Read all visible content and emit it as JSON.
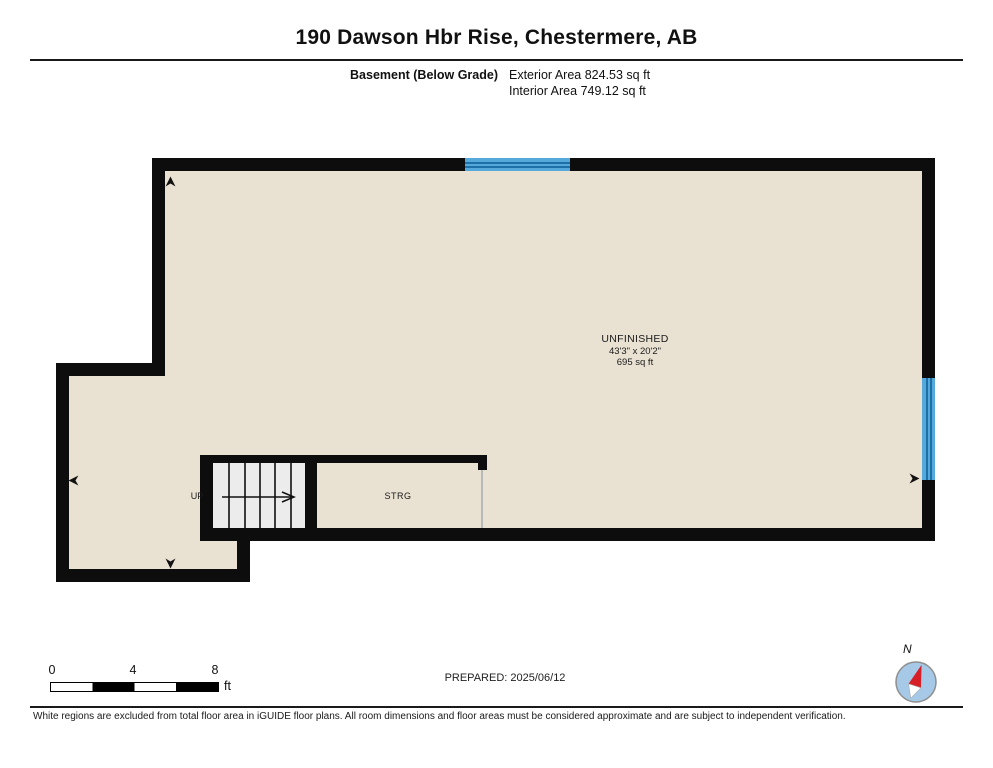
{
  "header": {
    "title": "190 Dawson Hbr Rise, Chestermere, AB",
    "floor_label": "Basement (Below Grade)",
    "exterior_area": "Exterior Area 824.53 sq ft",
    "interior_area": "Interior Area 749.12 sq ft"
  },
  "plan": {
    "room": {
      "name": "UNFINISHED",
      "dimensions": "43'3\" x 20'2\"",
      "area": "695 sq ft"
    },
    "stairs_label": "UP",
    "storage_label": "STRG"
  },
  "footer": {
    "scale_ticks": [
      "0",
      "4",
      "8"
    ],
    "scale_unit": "ft",
    "prepared": "PREPARED: 2025/06/12",
    "compass_label": "N",
    "disclaimer": "White regions are excluded from total floor area in iGUIDE floor plans. All room dimensions and floor areas must be considered approximate and are subject to independent verification."
  },
  "colors": {
    "floor": "#e9e1d1",
    "wall": "#0d0d0d",
    "window_fill": "#55a8da",
    "window_line": "#1d6fa8",
    "stairs_fill": "#ececec",
    "compass_blue": "#a5c9e6",
    "needle_red": "#d61f26"
  }
}
